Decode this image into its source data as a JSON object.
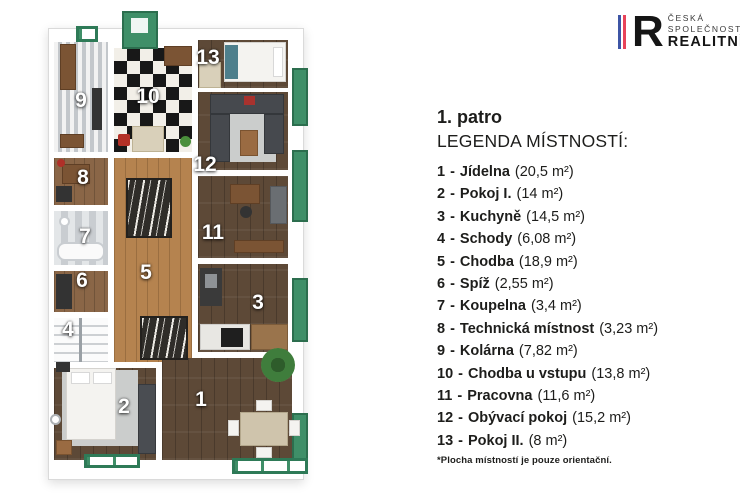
{
  "logo": {
    "line1": "ČESKÁ",
    "line2": "SPOLEČNOST",
    "line3": "REALITNÍ",
    "letter": "R",
    "blue": "#3d55a5",
    "red": "#e8435a"
  },
  "legend": {
    "floor_title": "1. patro",
    "heading": "LEGENDA MÍSTNOSTÍ:",
    "separator": "-",
    "rooms": [
      {
        "num": "1",
        "name": "Jídelna",
        "area": "(20,5 m²)"
      },
      {
        "num": "2",
        "name": "Pokoj I.",
        "area": "(14 m²)"
      },
      {
        "num": "3",
        "name": "Kuchyně",
        "area": "(14,5 m²)"
      },
      {
        "num": "4",
        "name": "Schody",
        "area": "(6,08 m²)"
      },
      {
        "num": "5",
        "name": "Chodba",
        "area": "(18,9 m²)"
      },
      {
        "num": "6",
        "name": "Spíž",
        "area": "(2,55 m²)"
      },
      {
        "num": "7",
        "name": "Koupelna",
        "area": "(3,4 m²)"
      },
      {
        "num": "8",
        "name": "Technická místnost",
        "area": "(3,23 m²)"
      },
      {
        "num": "9",
        "name": "Kolárna",
        "area": "(7,82 m²)"
      },
      {
        "num": "10",
        "name": "Chodba u vstupu",
        "area": "(13,8 m²)"
      },
      {
        "num": "11",
        "name": "Pracovna",
        "area": "(11,6 m²)"
      },
      {
        "num": "12",
        "name": "Obývací pokoj",
        "area": "(15,2 m²)"
      },
      {
        "num": "13",
        "name": "Pokoj II.",
        "area": "(8 m²)"
      }
    ],
    "footnote": "*Plocha místností je pouze orientační."
  },
  "plan": {
    "accent_green": "#3f8f68",
    "wall_color": "#ffffff"
  }
}
